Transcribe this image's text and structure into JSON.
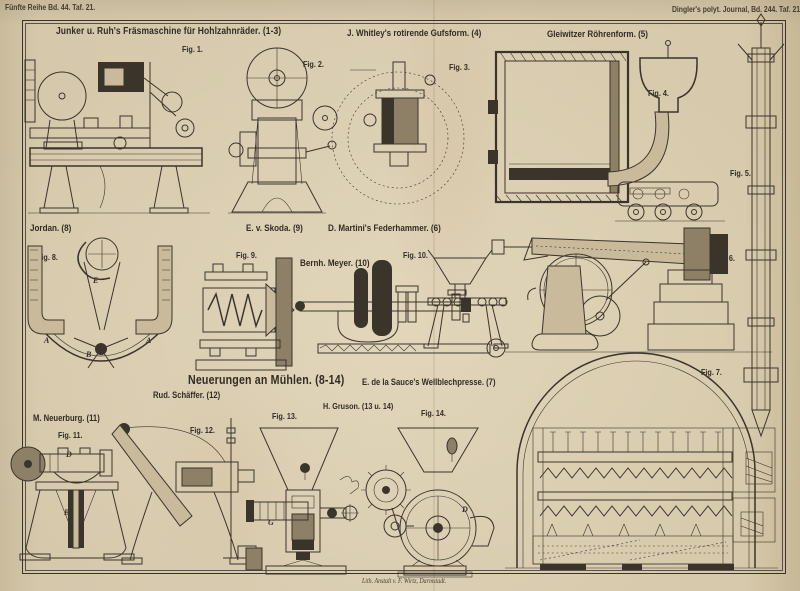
{
  "page": {
    "header_left": "Fünfte Reihe Bd. 44. Taf. 21.",
    "header_right": "Dingler's polyt. Journal, Bd. 244. Taf. 21.",
    "footer": "Lith. Anstalt v. F. Wirtz, Darmstadt.",
    "colors": {
      "paper": "#d9ccb0",
      "ink": "#3b342b"
    }
  },
  "sections": [
    {
      "title": "Junker u. Ruh's Fräsmaschine für Hohlzahnräder. (1-3)"
    },
    {
      "title": "J. Whitley's rotirende Gufsform. (4)"
    },
    {
      "title": "Gleiwitzer Röhrenform. (5)"
    },
    {
      "title": "Jordan. (8)"
    },
    {
      "title": "E. v. Skoda. (9)"
    },
    {
      "title": "D. Martini's Federhammer. (6)"
    },
    {
      "title": "Bernh. Meyer. (10)"
    },
    {
      "title": "Neuerungen an Mühlen. (8-14)"
    },
    {
      "title": "E. de la Sauce's Wellblechpresse. (7)"
    },
    {
      "title": "Rud. Schäffer. (12)"
    },
    {
      "title": "M. Neuerburg. (11)"
    },
    {
      "title": "H. Gruson. (13 u. 14)"
    }
  ],
  "figures": [
    {
      "label": "Fig. 1."
    },
    {
      "label": "Fig. 2."
    },
    {
      "label": "Fig. 3."
    },
    {
      "label": "Fig. 4."
    },
    {
      "label": "Fig. 5."
    },
    {
      "label": "Fig. 6."
    },
    {
      "label": "Fig. 7."
    },
    {
      "label": "Fig. 8."
    },
    {
      "label": "Fig. 9."
    },
    {
      "label": "Fig. 10."
    },
    {
      "label": "Fig. 11."
    },
    {
      "label": "Fig. 12."
    },
    {
      "label": "Fig. 13."
    },
    {
      "label": "Fig. 14."
    }
  ],
  "letters": [
    {
      "text": "F"
    },
    {
      "text": "E"
    },
    {
      "text": "F"
    },
    {
      "text": "A"
    },
    {
      "text": "A"
    },
    {
      "text": "B"
    },
    {
      "text": "D"
    },
    {
      "text": "B"
    },
    {
      "text": "d"
    },
    {
      "text": "G"
    },
    {
      "text": "D"
    }
  ]
}
